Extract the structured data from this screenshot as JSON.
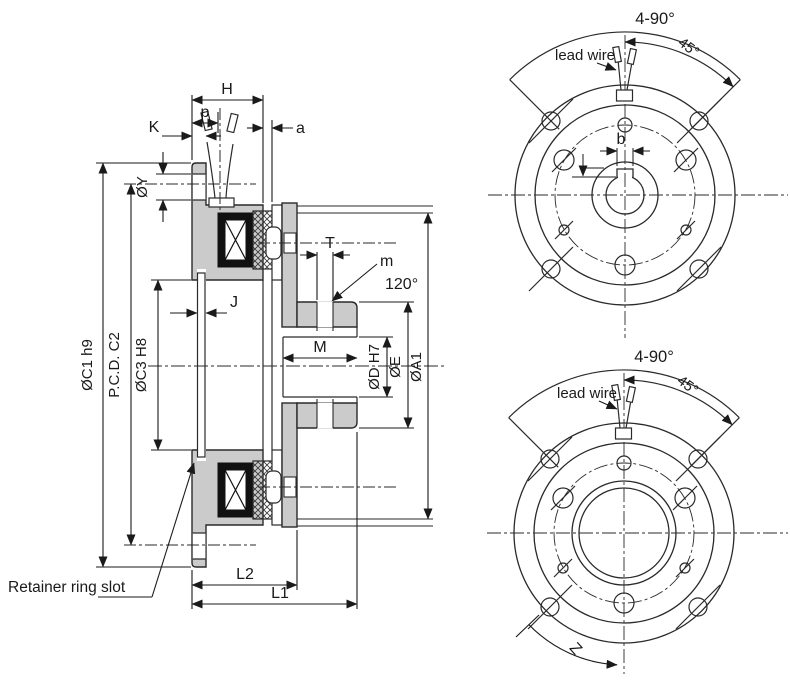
{
  "title": "Electromagnetic clutch engineering drawing",
  "colors": {
    "background": "#ffffff",
    "body_fill": "#cbcbcb",
    "line": "#2a2a2a",
    "coil_fill": "#111111"
  },
  "section_view": {
    "dim_H": "H",
    "dim_p": "p",
    "dim_K": "K",
    "dim_a": "a",
    "dim_phiY": "ØY",
    "dim_T": "T",
    "dim_m": "m",
    "dim_120": "120°",
    "dim_M": "M",
    "dim_phiD": "ØD H7",
    "dim_phiE": "ØE",
    "dim_phiA1": "ØA1",
    "dim_phiC1": "ØC1 h9",
    "dim_PCD": "P.C.D. C2",
    "dim_phiC3": "ØC3 H8",
    "dim_J": "J",
    "dim_L2": "L2",
    "dim_L1": "L1",
    "note_retainer": "Retainer ring slot"
  },
  "front_view_top": {
    "dim_holes": "4-90°",
    "dim_45": "45°",
    "label_lead_wire": "lead wire",
    "dim_b": "b"
  },
  "front_view_bottom": {
    "dim_holes": "4-90°",
    "dim_45": "45°",
    "label_lead_wire": "lead wire",
    "dim_Z": "Z"
  }
}
